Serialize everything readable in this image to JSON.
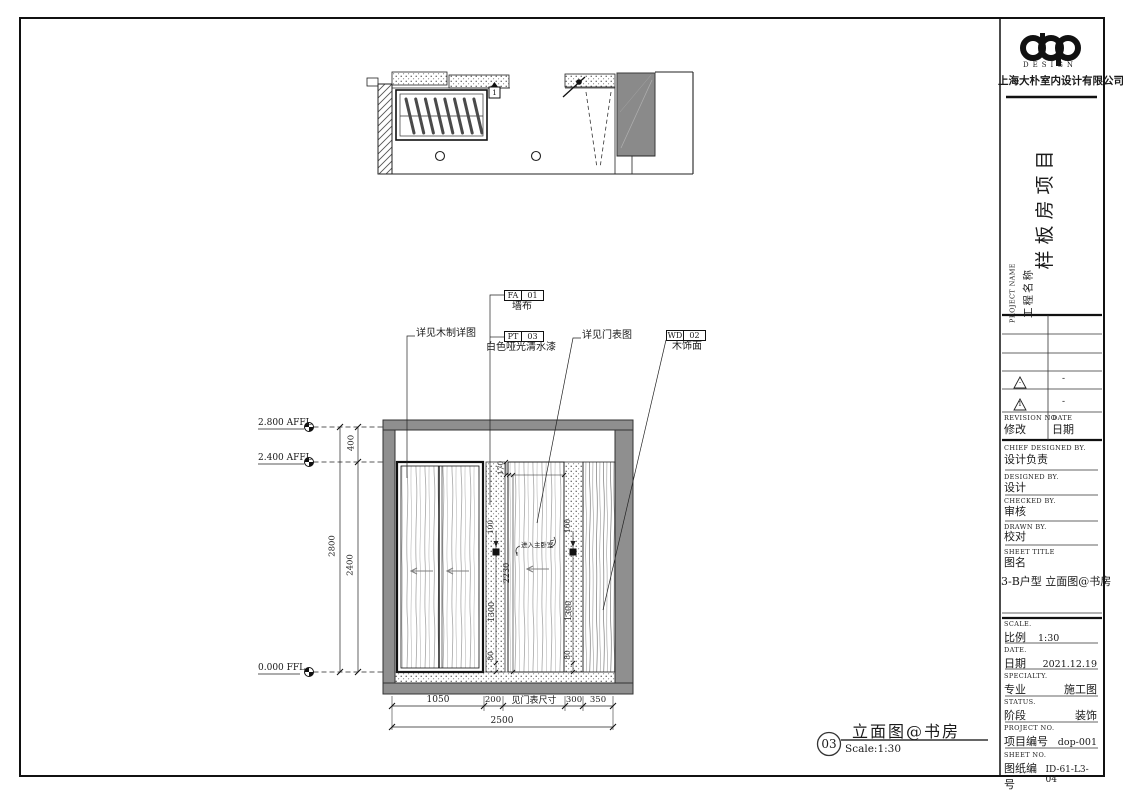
{
  "colors": {
    "fill_gray": "#8f8f8f",
    "line": "#1a1a1a"
  },
  "title_block": {
    "brand": "dop",
    "brand_sub": "DESIGN",
    "company": "上海大朴室内设计有限公司",
    "project_title": "样板房项目",
    "project_name_en": "PROJECT NAME",
    "project_name_cn": "工程名称",
    "revision": {
      "en_no": "REVISION NO",
      "en_date": "DATE",
      "cn_no": "修改",
      "cn_date": "日期",
      "upper_mark": "-",
      "lower_mark": "1",
      "upper_date": "-",
      "lower_date": "-"
    },
    "fields": [
      {
        "en": "CHIEF DESIGNED BY.",
        "cn": "设计负责",
        "value": ""
      },
      {
        "en": "DESIGNED BY.",
        "cn": "设计",
        "value": ""
      },
      {
        "en": "CHECKED BY.",
        "cn": "审核",
        "value": ""
      },
      {
        "en": "DRAWN BY.",
        "cn": "校对",
        "value": ""
      },
      {
        "en": "SHEET TITLE",
        "cn": "图名",
        "value": "3-B户型 立面图@书房"
      },
      {
        "en": "SCALE.",
        "cn": "比例",
        "value": "1:30"
      },
      {
        "en": "DATE.",
        "cn": "日期",
        "value": "2021.12.19"
      },
      {
        "en": "SPECIALTY.",
        "cn": "专业",
        "value": "施工图"
      },
      {
        "en": "STATUS.",
        "cn": "阶段",
        "value": "装饰"
      },
      {
        "en": "PROJECT NO.",
        "cn": "项目编号",
        "value": "dop-001"
      },
      {
        "en": "SHEET NO.",
        "cn": "图纸编号",
        "value": "ID-61-L3-04"
      }
    ]
  },
  "drawing": {
    "callouts": {
      "fa": {
        "code": "FA",
        "num": "01",
        "name": "墙布"
      },
      "pt": {
        "code": "PT",
        "num": "03",
        "name": "白色哑光清水漆"
      },
      "wd": {
        "code": "WD",
        "num": "02",
        "name": "木饰面"
      }
    },
    "notes": {
      "wood_detail": "详见木制详图",
      "door_schedule": "详见门表图"
    },
    "levels": {
      "top": "2.800 AFFL",
      "mid": "2.400 AFFL",
      "bottom": "0.000 FFL"
    },
    "vdims": {
      "d400": "400",
      "d2800": "2800",
      "d2400": "2400",
      "d170": "170",
      "d2230": "2230",
      "d100": "100",
      "d1300": "1300",
      "d80": "80"
    },
    "hdims": {
      "d1050": "1050",
      "d200": "200",
      "door": "见门表尺寸",
      "d300": "300",
      "d350": "350",
      "total": "2500"
    },
    "door_label": "进入主卧室",
    "plan_marker": "1",
    "view_title": {
      "number": "03",
      "name": "立面图@书房",
      "scale": "Scale:1:30"
    }
  }
}
